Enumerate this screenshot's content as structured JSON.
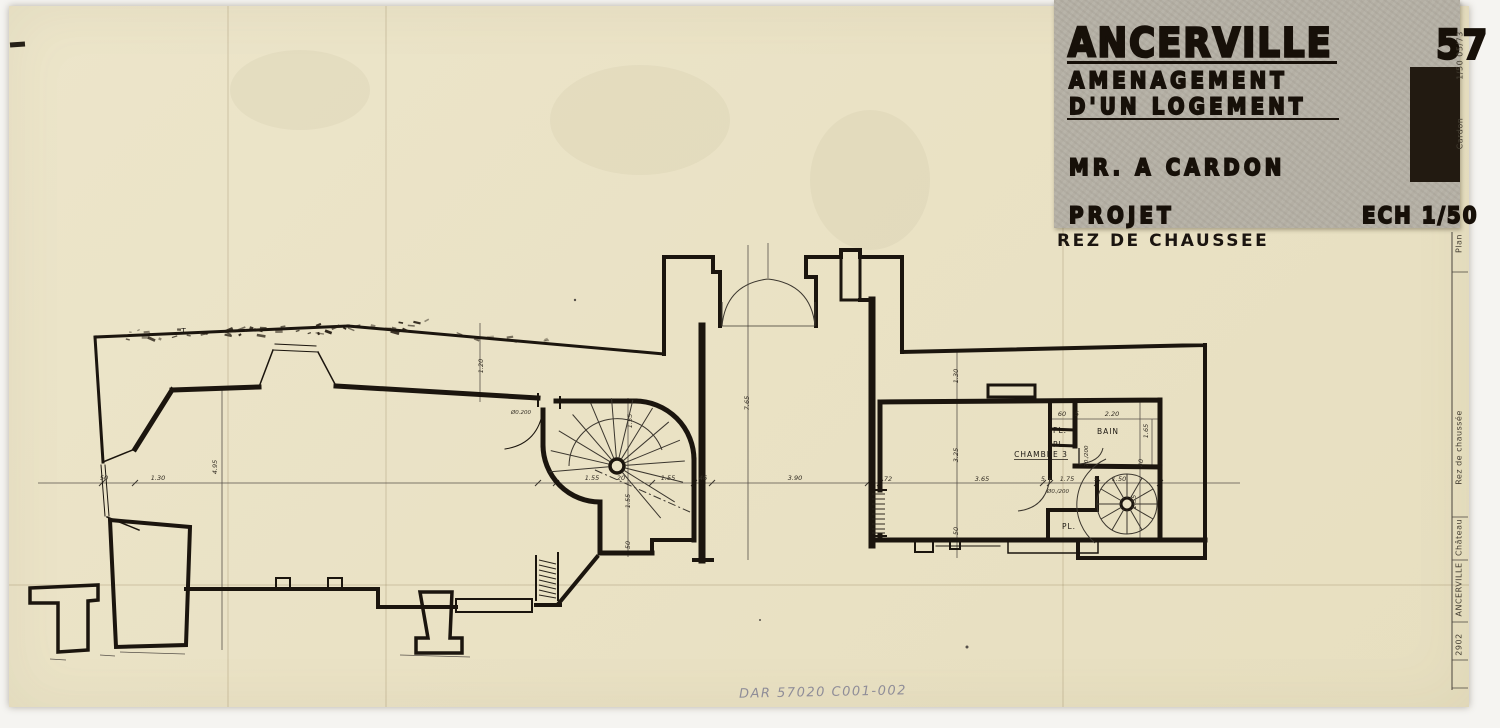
{
  "title_block": {
    "city": "ANCERVILLE",
    "dept": "57",
    "line2": "AMENAGEMENT",
    "line3": "D'UN LOGEMENT",
    "client": "MR. A CARDON",
    "phase": "PROJET",
    "scale": "ECH 1/50",
    "subtitle": "REZ DE CHAUSSEE"
  },
  "margin_strip": {
    "top_items": [
      {
        "label": "1/50   05/73",
        "x": 1460,
        "y": 58
      },
      {
        "label": "Cardon",
        "x": 1460,
        "y": 136
      }
    ],
    "items": [
      {
        "label": "Plan",
        "x": 1459,
        "y": 246
      },
      {
        "label": "Rez de chaussée",
        "x": 1459,
        "y": 450
      },
      {
        "label": "Château",
        "x": 1459,
        "y": 540
      },
      {
        "label": "ANCERVILLE",
        "x": 1459,
        "y": 592
      },
      {
        "label": "2902",
        "x": 1459,
        "y": 647
      }
    ]
  },
  "plan": {
    "room_labels": [
      {
        "t": "PL.",
        "x": 1060,
        "y": 433
      },
      {
        "t": "PL.",
        "x": 1060,
        "y": 447
      },
      {
        "t": "BAIN",
        "x": 1108,
        "y": 434
      },
      {
        "t": "CHAMBRE 3",
        "x": 1041,
        "y": 457,
        "u": 1
      },
      {
        "t": "PL.",
        "x": 1069,
        "y": 529
      },
      {
        "t": "T",
        "x": 184,
        "y": 334
      }
    ],
    "dim_labels": [
      {
        "t": "50",
        "x": 104,
        "y": 480
      },
      {
        "t": "1.30",
        "x": 158,
        "y": 480
      },
      {
        "t": "1.55",
        "x": 592,
        "y": 480
      },
      {
        "t": "20",
        "x": 621,
        "y": 480
      },
      {
        "t": "1.55",
        "x": 668,
        "y": 480
      },
      {
        "t": "46",
        "x": 703,
        "y": 480
      },
      {
        "t": "3.90",
        "x": 795,
        "y": 480
      },
      {
        "t": "72",
        "x": 888,
        "y": 481
      },
      {
        "t": "3.65",
        "x": 982,
        "y": 481
      },
      {
        "t": "5",
        "x": 1043,
        "y": 481
      },
      {
        "t": "1.75",
        "x": 1067,
        "y": 481
      },
      {
        "t": "5",
        "x": 1096,
        "y": 481
      },
      {
        "t": "1.50",
        "x": 1119,
        "y": 481
      },
      {
        "t": "Ø0./200",
        "x": 1058,
        "y": 493,
        "s": 5.5
      },
      {
        "t": "Ø0.200",
        "x": 521,
        "y": 414,
        "s": 5.5
      },
      {
        "t": "60",
        "x": 1062,
        "y": 416
      },
      {
        "t": "5",
        "x": 1077,
        "y": 416
      },
      {
        "t": "2.20",
        "x": 1112,
        "y": 416
      },
      {
        "t": "4.95",
        "x": 217,
        "y": 467,
        "r": 1
      },
      {
        "t": "1.20",
        "x": 483,
        "y": 366,
        "r": 1
      },
      {
        "t": "1.55",
        "x": 632,
        "y": 421,
        "r": 1
      },
      {
        "t": "1.55",
        "x": 630,
        "y": 501,
        "r": 1
      },
      {
        "t": "50",
        "x": 630,
        "y": 545,
        "r": 1
      },
      {
        "t": "7.65",
        "x": 749,
        "y": 403,
        "r": 1
      },
      {
        "t": "1.30",
        "x": 958,
        "y": 376,
        "r": 1
      },
      {
        "t": "3.25",
        "x": 958,
        "y": 455,
        "r": 1
      },
      {
        "t": "50",
        "x": 958,
        "y": 531,
        "r": 1
      },
      {
        "t": "1.65",
        "x": 1148,
        "y": 431,
        "r": 1
      },
      {
        "t": "40",
        "x": 1143,
        "y": 463,
        "r": 1
      },
      {
        "t": "1.55",
        "x": 1136,
        "y": 502,
        "r": 1
      },
      {
        "t": "70./200",
        "x": 1088,
        "y": 456,
        "r": 1,
        "s": 5.5
      }
    ]
  },
  "annotations": {
    "pencil_note": "DAR 57020 C001-002"
  }
}
